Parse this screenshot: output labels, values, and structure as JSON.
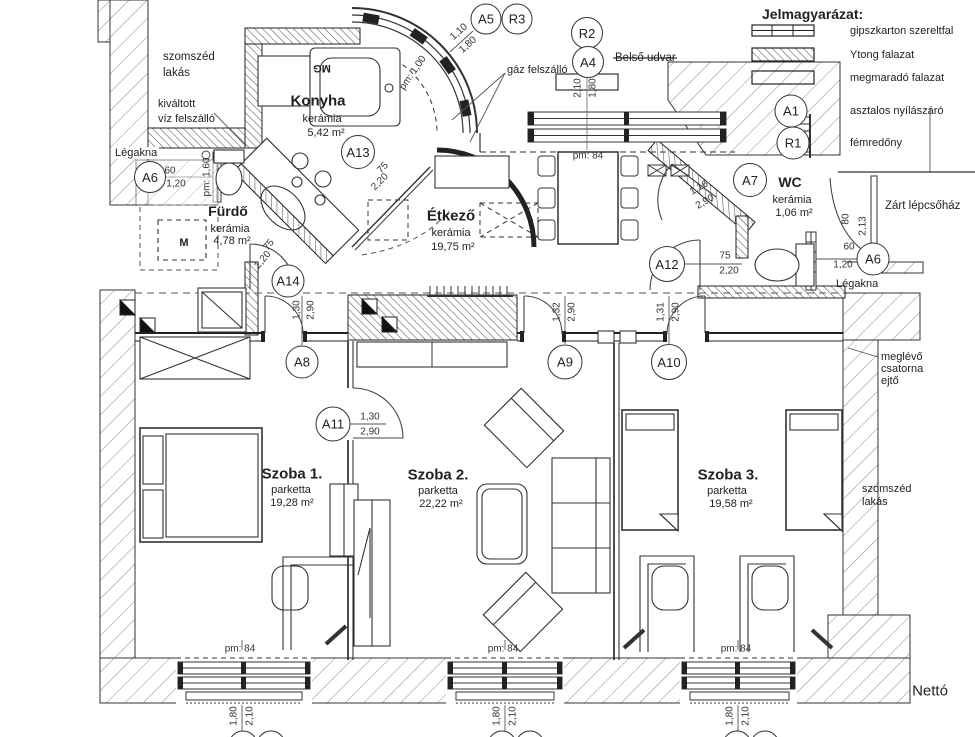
{
  "legend": {
    "title": "Jelmagyarázat:",
    "items": [
      {
        "symbol": "gipszkarton-wall-symbol",
        "label": "gipszkarton szereltfal"
      },
      {
        "symbol": "ytong-wall-symbol",
        "label": "Ytong falazat"
      },
      {
        "symbol": "remaining-wall-symbol",
        "label": "megmaradó falazat"
      },
      {
        "symbol": "marker-circle-a1",
        "label": "asztalos nyílászáró"
      },
      {
        "symbol": "marker-circle-r1",
        "label": "fémredőny"
      }
    ]
  },
  "markers": {
    "a1": "A1",
    "r1": "R1",
    "r2": "R2",
    "r3": "R3",
    "a4": "A4",
    "a5": "A5",
    "a6_left": "A6",
    "a6_right": "A6",
    "a7": "A7",
    "a8": "A8",
    "a9": "A9",
    "a10": "A10",
    "a11": "A11",
    "a12": "A12",
    "a13": "A13",
    "a14": "A14"
  },
  "rooms": {
    "konyha": {
      "name": "Konyha",
      "material": "kerámia",
      "area": "5,42 m²"
    },
    "furdo": {
      "name": "Fürdő",
      "material": "kerámia",
      "area": "4,78 m²"
    },
    "etkezo": {
      "name": "Étkező",
      "material": "kerámia",
      "area": "19,75 m²"
    },
    "wc": {
      "name": "WC",
      "material": "kerámia",
      "area": "1,06 m²"
    },
    "szoba1": {
      "name": "Szoba 1.",
      "material": "parketta",
      "area": "19,28 m²"
    },
    "szoba2": {
      "name": "Szoba 2.",
      "material": "parketta",
      "area": "22,22 m²"
    },
    "szoba3": {
      "name": "Szoba 3.",
      "material": "parketta",
      "area": "19,58 m²"
    }
  },
  "annotations": {
    "szomszed_lakas_top": [
      "szomszéd",
      "lakás"
    ],
    "szomszed_lakas_right": [
      "szomszéd",
      "lakás"
    ],
    "kivaltott": [
      "kiváltott",
      "víz felszálló"
    ],
    "meglevo": [
      "meglévő",
      "csatorna",
      "ejtő"
    ],
    "legakna_left": "Légakna",
    "legakna_right": "Légakna",
    "belso_udvar": "Belső udvar",
    "gaz_felszallo": "gáz felszálló",
    "zart_lepcsohaz": "Zárt lépcsőház",
    "netto": "Nettó",
    "washing_machine_mg": "MG",
    "washing_machine_m": "M"
  },
  "dims": {
    "a5_r3": [
      "1,10",
      "1,80"
    ],
    "a4_r2": [
      "2,10",
      "1,80"
    ],
    "a6_left": [
      "60",
      "1,20"
    ],
    "a6_right": [
      "60",
      "1,20"
    ],
    "stair": [
      "80",
      "2,13"
    ],
    "a7": [
      "1,16",
      "2,90"
    ],
    "a12": [
      "75",
      "2,20"
    ],
    "a13": [
      "75",
      "2,20"
    ],
    "a14": [
      "75",
      "2,20"
    ],
    "a8": [
      "1,30",
      "2,90"
    ],
    "a9": [
      "1,32",
      "2,90"
    ],
    "a10": [
      "1,31",
      "2,90"
    ],
    "a11": [
      "1,30",
      "2,90"
    ],
    "window_bottom": [
      "1,80",
      "2,10"
    ],
    "sill_84": "pm: 84",
    "sill_160": "pm: 1,60",
    "sill_100": "pm: 1,00"
  }
}
